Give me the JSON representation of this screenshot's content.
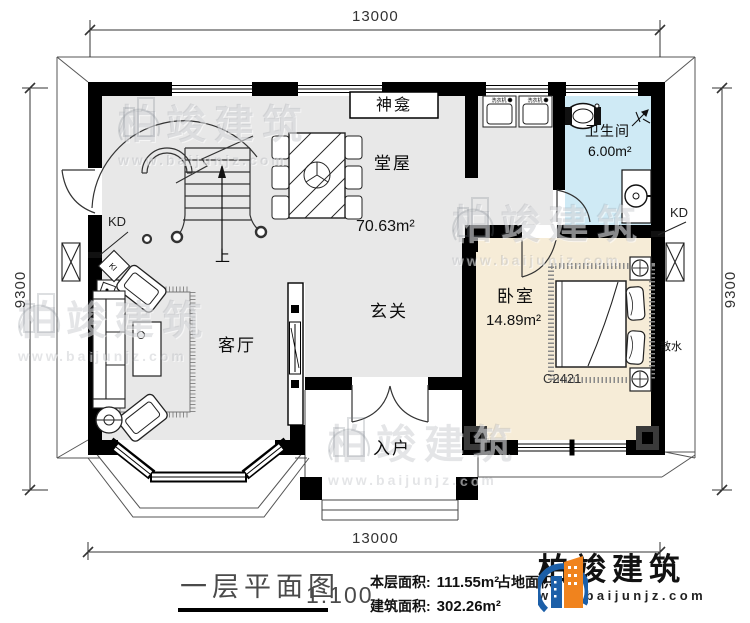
{
  "plan": {
    "dims": {
      "horizontal": "13000",
      "vertical": "9300"
    },
    "rooms": {
      "shrine": {
        "name": "神龛"
      },
      "hall": {
        "name": "堂屋",
        "area": "70.63m²"
      },
      "bathroom": {
        "name": "卫生间",
        "area": "6.00m²"
      },
      "bedroom": {
        "name": "卧室",
        "area": "14.89m²",
        "window": "C2421"
      },
      "living": {
        "name": "客厅"
      },
      "foyer": {
        "name": "玄关"
      },
      "entry": {
        "name": "入户"
      }
    },
    "labels": {
      "kd": "KD",
      "up": "上",
      "apron": "散水",
      "washer": "洗衣机",
      "ki": "KI"
    },
    "colors": {
      "wall": "#000000",
      "floor": "#e8e8e8",
      "bathroom": "#cfeaf5",
      "bedroom": "#f6ecd7"
    }
  },
  "watermark": {
    "brand": "柏竣建筑",
    "url": "www.baijunjz.com"
  },
  "footer": {
    "title": "一层平面图",
    "scale": "1:100",
    "floor_area_label": "本层面积:",
    "floor_area_value": "111.55m²",
    "build_area_label": "建筑面积:",
    "build_area_value": "302.26m²",
    "land_area_label": "占地面积:",
    "brand": "柏竣建筑",
    "url": "www.baijunjz.com",
    "brand_blue": "#1c5fa8",
    "brand_orange": "#f0831e"
  }
}
